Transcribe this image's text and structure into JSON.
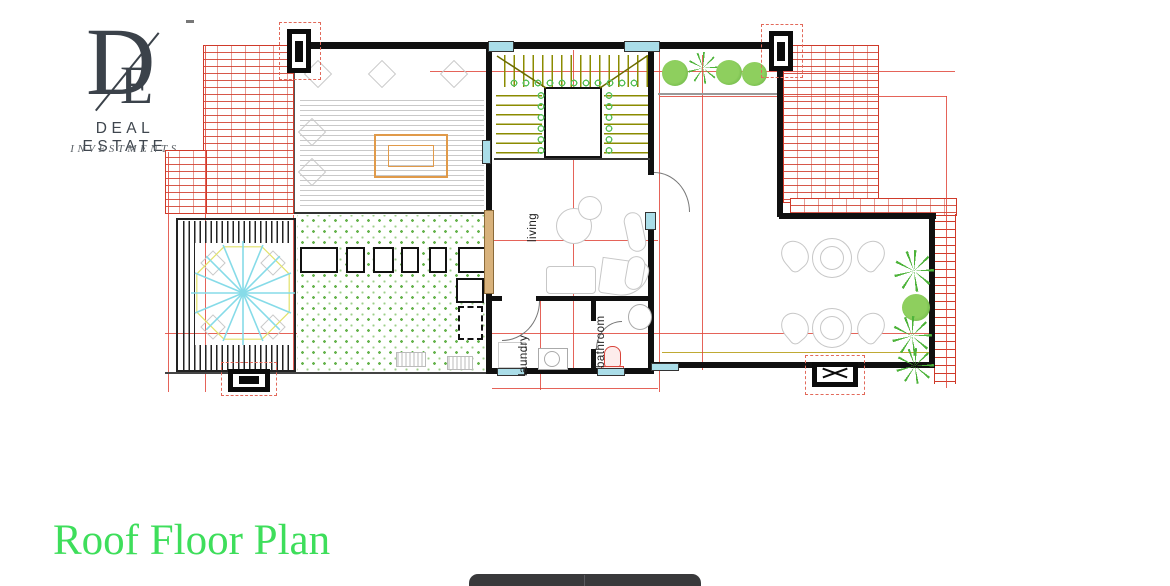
{
  "brand": {
    "monogram_d": "D",
    "monogram_e": "E",
    "name": "DEAL ESTATE",
    "tagline": "INVESTMENTS"
  },
  "plan": {
    "rooms": [
      {
        "label": "living"
      },
      {
        "label": "laundry"
      },
      {
        "label": "bathroom"
      }
    ]
  },
  "title": "Roof Floor Plan",
  "colors": {
    "title_green": "#3ede5b",
    "hatch_red": "#cf3a2a",
    "dimension_red": "#e0483c",
    "column_cyan": "#aadde8",
    "stair_olive": "#8b8b00",
    "lawn_green": "#66b34d",
    "logo_ink": "#3b424a",
    "bottom_bar_dark": "#39393b"
  }
}
